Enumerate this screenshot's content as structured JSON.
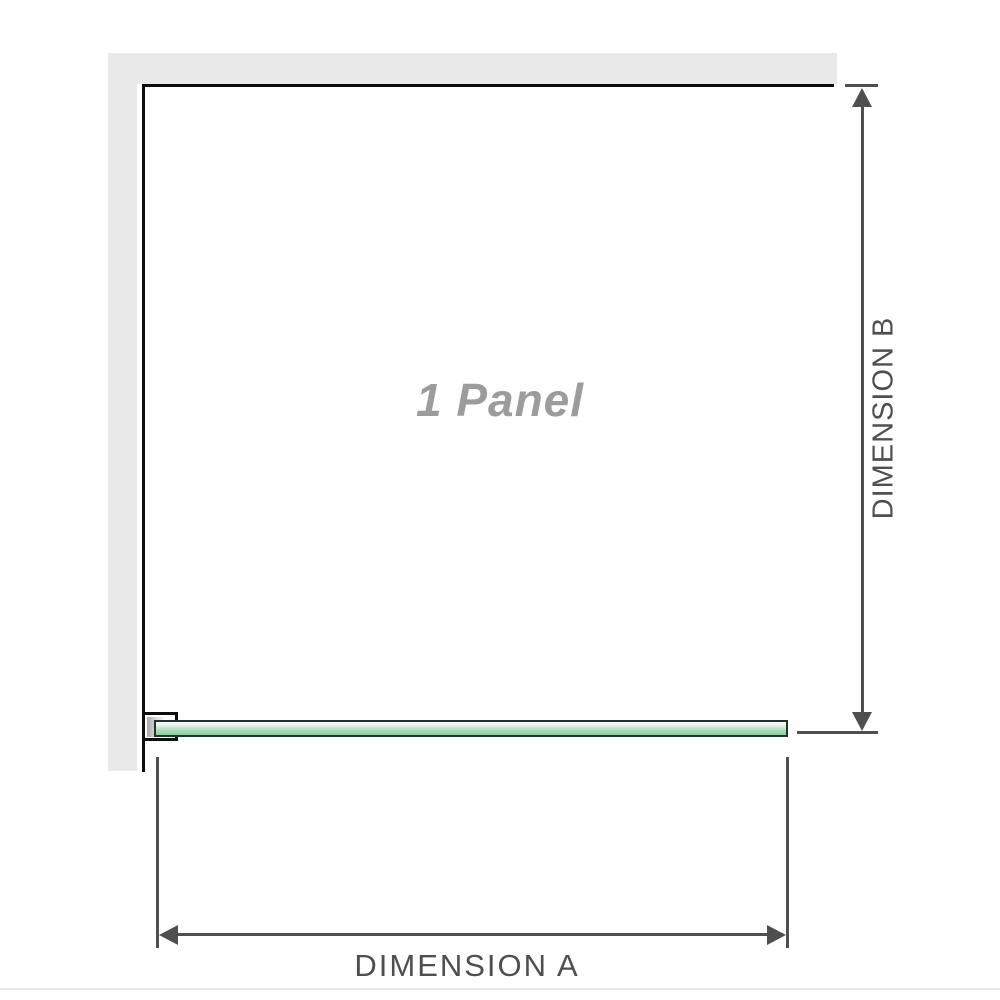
{
  "diagram": {
    "panel_label": "1 Panel",
    "dimension_a_label": "DIMENSION A",
    "dimension_b_label": "DIMENSION B"
  },
  "colors": {
    "wall-gray": "#e9e9e9",
    "outline-black": "#0d0d0d",
    "dimension-gray": "#4f4f4f",
    "panel-label-gray": "#9c9c9c",
    "glass-green": "#a9dcba",
    "glass-border": "#203428",
    "bottom-rule": "#e9e8e4"
  }
}
